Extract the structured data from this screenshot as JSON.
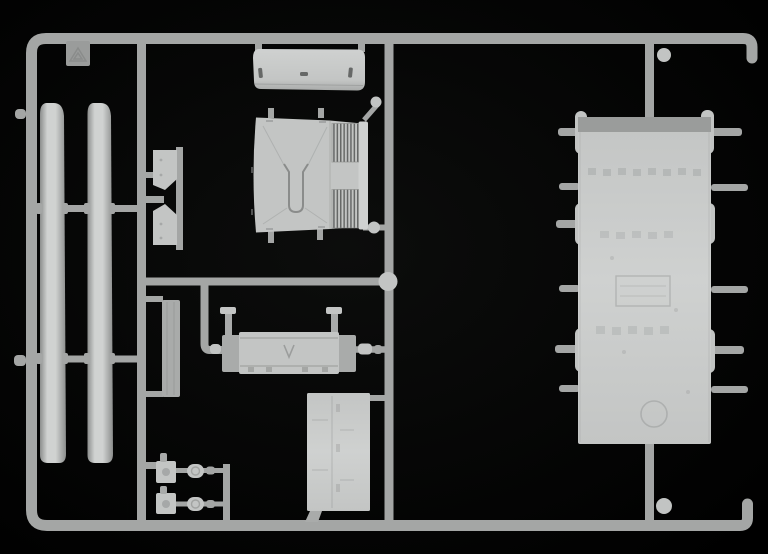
{
  "scene": {
    "description": "Photograph of a light grey injection-moulded model kit sprue with locomotive parts on a black background",
    "colors": {
      "bg": "#050505",
      "runner": "#a4a6a5",
      "runner-light": "#c2c4c3",
      "part": "#c3c5c4",
      "part-light": "#cfd1d0",
      "part-dark": "#a9abaa",
      "panel-band": "#9a9c9b",
      "detail": "#8a8c8b",
      "grille-dark": "#666867",
      "strip-edge": "#8c8e8d",
      "strip-mid": "#d0d2d1"
    }
  },
  "icons": [
    {
      "name": "recycling-triangle-icon",
      "meaning": "embossed recycling material symbol on mold tab"
    }
  ],
  "parts": [
    {
      "name": "sprue-frame",
      "label": "outer runner frame"
    },
    {
      "name": "roof-strip-a",
      "label": "long curved strip part (left)"
    },
    {
      "name": "roof-strip-b",
      "label": "long curved strip part (right)"
    },
    {
      "name": "mold-stamp-tab",
      "label": "square tab with recycling symbol"
    },
    {
      "name": "hood-roof-panel",
      "label": "curved hood panel with three slots"
    },
    {
      "name": "cab-front-panel",
      "label": "locomotive cab front with twin radiator grilles"
    },
    {
      "name": "latch-plate-a",
      "label": "small notched plate (upper)"
    },
    {
      "name": "latch-plate-b",
      "label": "small notched plate (lower)"
    },
    {
      "name": "radiator-slat",
      "label": "tall thin slat part"
    },
    {
      "name": "chassis-underframe",
      "label": "buffer beam underframe with two buffer pins"
    },
    {
      "name": "side-door-panel",
      "label": "rectangular side door panel"
    },
    {
      "name": "hull-roof-panel",
      "label": "large flat hull/roof panel with side gate pins"
    },
    {
      "name": "lamp-bracket-a",
      "label": "small square lamp bracket (upper row)"
    },
    {
      "name": "lantern-a",
      "label": "small round lantern (upper row)"
    },
    {
      "name": "lamp-bracket-b",
      "label": "small square lamp bracket (lower row)"
    },
    {
      "name": "lantern-b",
      "label": "small round lantern (lower row)"
    },
    {
      "name": "gate-balls",
      "label": "round sprue gate knobs"
    }
  ]
}
